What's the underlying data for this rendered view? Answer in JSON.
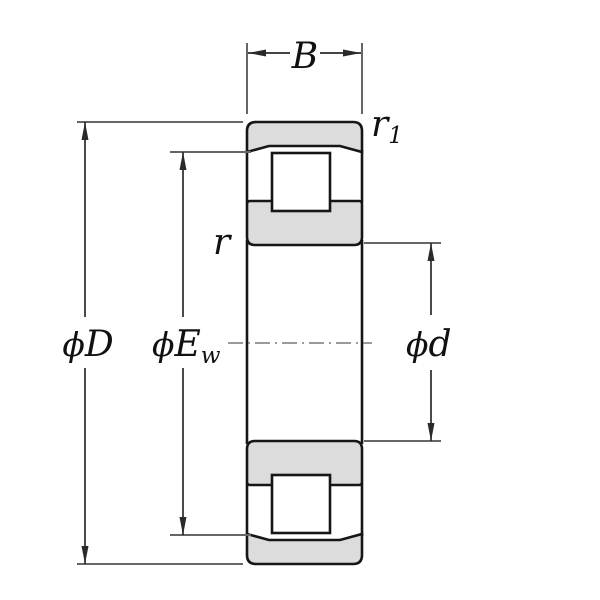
{
  "labels": {
    "width": "B",
    "outer_ring_chamfer": {
      "base": "r",
      "sub": "1"
    },
    "inner_ring_chamfer": {
      "base": "r"
    },
    "outer_diameter": {
      "phi": "ϕ",
      "base": "D"
    },
    "raceway_diameter": {
      "phi": "ϕ",
      "base": "E",
      "sub": "w"
    },
    "bore_diameter": {
      "phi": "ϕ",
      "base": "d"
    }
  },
  "colors": {
    "background": "#ffffff",
    "ring_fill": "#dcdcdc",
    "roller_fill": "#ffffff",
    "outline": "#161616",
    "dimension_line": "#2a2a2a",
    "extension_line": "#666666",
    "centerline": "#787878",
    "label_text": "#111111"
  }
}
